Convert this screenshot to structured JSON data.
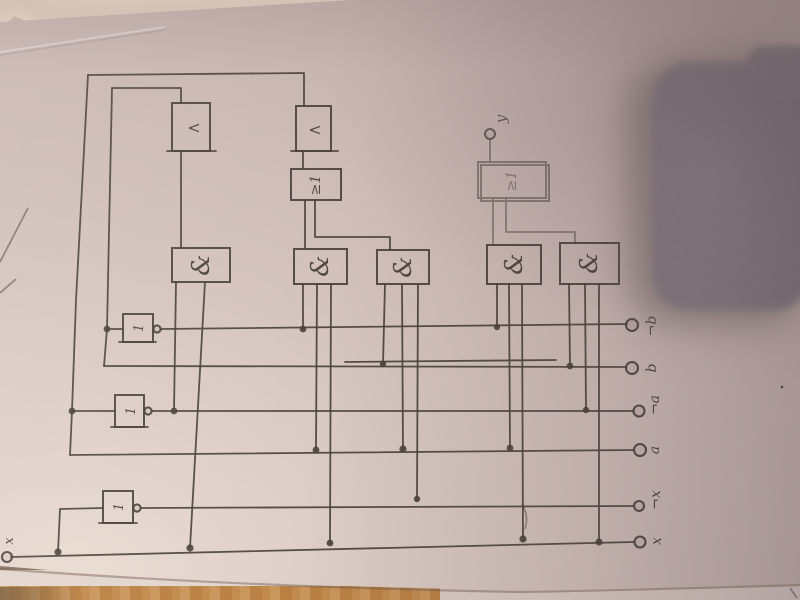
{
  "colors": {
    "ink": "#4a423b",
    "paper": "#d3c2bc",
    "wood": "#bf8a4b",
    "dark_object": "#857b81"
  },
  "circuit": {
    "input_label": "x",
    "output_label": "y",
    "terminals": [
      {
        "label": "¬b"
      },
      {
        "label": "b"
      },
      {
        "label": "¬a"
      },
      {
        "label": "a"
      },
      {
        "label": "¬x"
      },
      {
        "label": "x"
      }
    ],
    "glyphs": {
      "and": "&",
      "or": "≥1",
      "not": "1",
      "clock": "<"
    }
  }
}
